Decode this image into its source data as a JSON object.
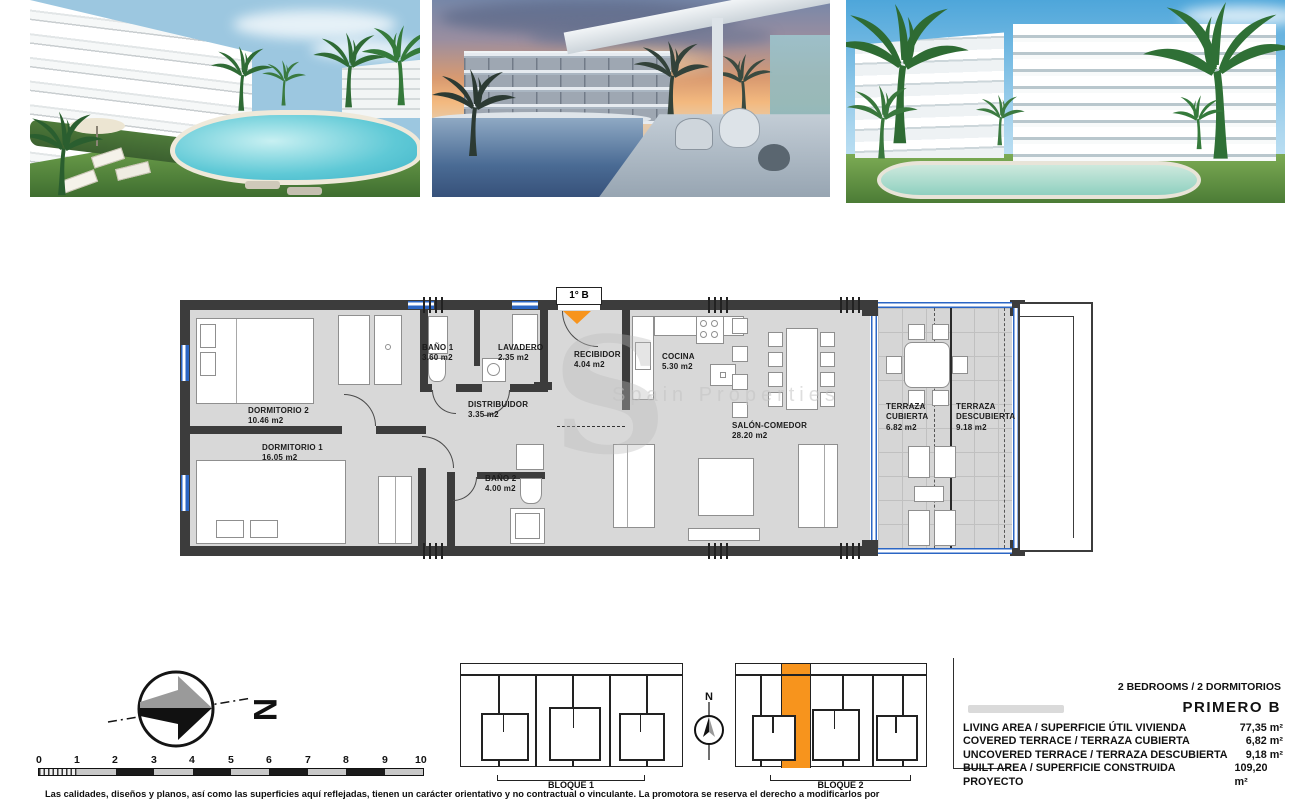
{
  "photos": [
    {
      "alt": "Daytime render: white apartment building, lagoon pool, palm trees and sun loungers"
    },
    {
      "alt": "Sunset render: terrace with chairs overlooking pool and apartment block"
    },
    {
      "alt": "Daytime render: two white apartment blocks with balconies, pool and palm trees"
    }
  ],
  "floorplan": {
    "unit_label": "1° B",
    "watermark_letter": "S",
    "watermark_text": "Spain Properties",
    "rooms": [
      {
        "name": "DORMITORIO 2",
        "area": "10.46 m2"
      },
      {
        "name": "DORMITORIO 1",
        "area": "16.05 m2"
      },
      {
        "name": "BAÑO 1",
        "area": "3.60 m2"
      },
      {
        "name": "LAVADERO",
        "area": "2.35 m2"
      },
      {
        "name": "RECIBIDOR",
        "area": "4.04 m2"
      },
      {
        "name": "DISTRIBUIDOR",
        "area": "3.35 m2"
      },
      {
        "name": "BAÑO 2",
        "area": "4.00 m2"
      },
      {
        "name": "COCINA",
        "area": "5.30 m2"
      },
      {
        "name": "SALÓN-COMEDOR",
        "area": "28.20 m2"
      },
      {
        "name": "TERRAZA CUBIERTA",
        "area": "6.82 m2"
      },
      {
        "name": "TERRAZA DESCUBIERTA",
        "area": "9.18 m2"
      }
    ]
  },
  "compass": {
    "big_label": "N",
    "small_label": "N"
  },
  "scalebar": {
    "ticks": [
      "0",
      "1",
      "2",
      "3",
      "4",
      "5",
      "6",
      "7",
      "8",
      "9",
      "10"
    ]
  },
  "blocks": [
    {
      "label": "BLOQUE 1"
    },
    {
      "label": "BLOQUE 2"
    }
  ],
  "info": {
    "bedrooms_line": "2 BEDROOMS / 2 DORMITORIOS",
    "unit_name": "PRIMERO B",
    "rows": [
      {
        "label": "LIVING AREA / SUPERFICIE ÚTIL VIVIENDA",
        "value": "77,35 m²"
      },
      {
        "label": "COVERED TERRACE / TERRAZA CUBIERTA",
        "value": "6,82 m²"
      },
      {
        "label": "UNCOVERED TERRACE / TERRAZA DESCUBIERTA",
        "value": "9,18 m²"
      },
      {
        "label": "BUILT AREA / SUPERFICIE CONSTRUIDA PROYECTO",
        "value": "109,20 m²"
      }
    ]
  },
  "disclaimer": "Las calidades, diseños y planos, así como las superficies aquí reflejadas, tienen un carácter orientativo y no contractual o vinculante. La promotora se reserva el derecho a modificarlos por",
  "colors": {
    "accent_orange": "#f7941d",
    "glass_blue": "#2b66c4",
    "wall_dark": "#3c3c3c",
    "floor_gray": "#d8d8d8"
  }
}
